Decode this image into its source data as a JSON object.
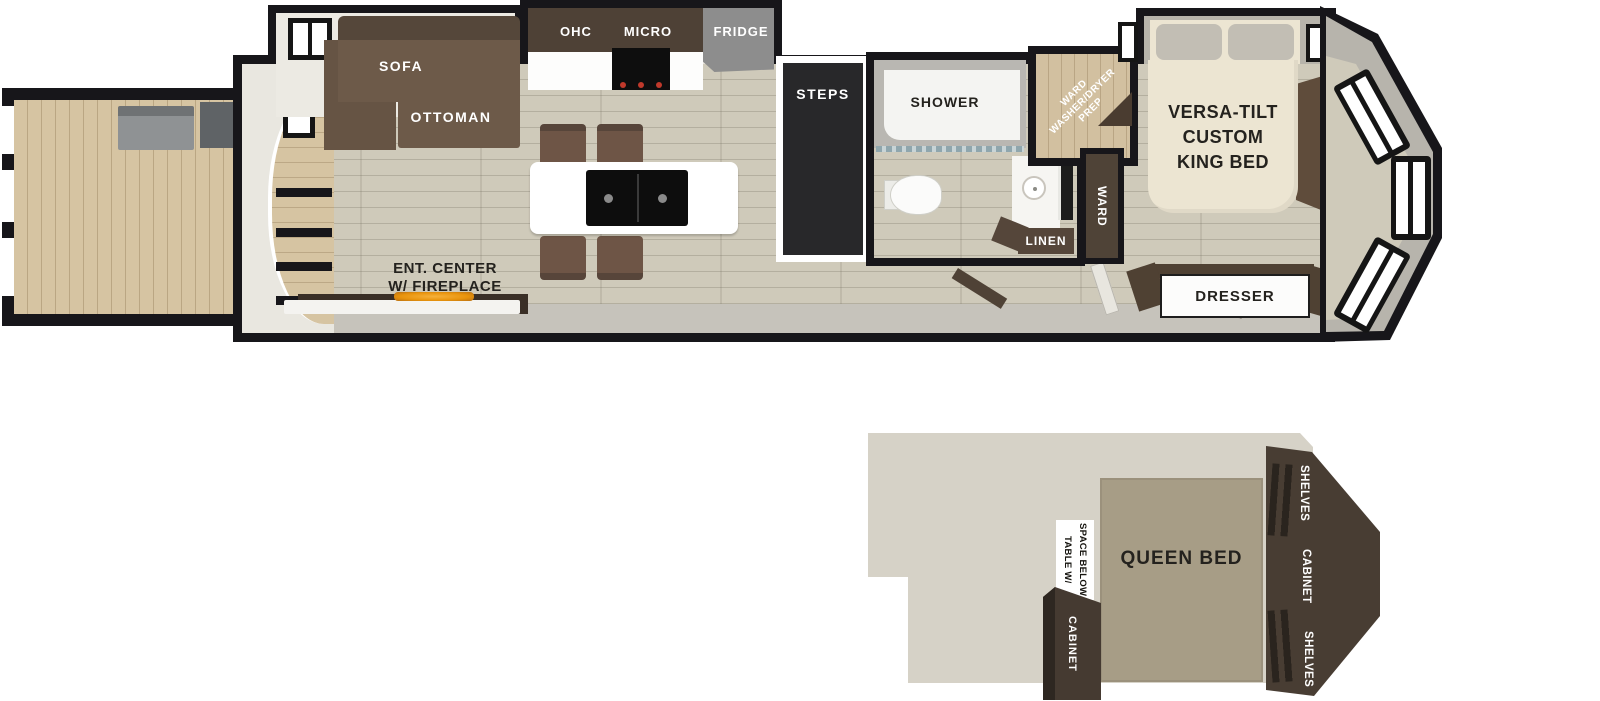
{
  "colors": {
    "wall": "#17161a",
    "floor_main": "#cfcaba",
    "floor_wood": "#d6c4a2",
    "furniture_brown": "#6d5a49",
    "cabinet_dark": "#463a30",
    "counter_white": "#ffffff",
    "fridge_gray": "#8d8d8d",
    "steps_black": "#28282a",
    "bed_cream": "#ece5d2",
    "queen_bed_tan": "#a79d86",
    "loft_floor": "#d6d2c7",
    "fireplace_glow": "#e8930c"
  },
  "main_floor": {
    "living": {
      "sofa": "SOFA",
      "ottoman": "OTTOMAN",
      "ent_center_line1": "ENT. CENTER",
      "ent_center_line2": "W/ FIREPLACE"
    },
    "kitchen": {
      "ohc": "OHC",
      "micro": "MICRO",
      "fridge": "FRIDGE"
    },
    "steps": "STEPS",
    "bath": {
      "shower": "SHOWER",
      "linen": "LINEN"
    },
    "utility": {
      "wd_line1": "WARD",
      "wd_line2": "WASHER/DRYER",
      "wd_line3": "PREP",
      "ward": "WARD"
    },
    "bedroom": {
      "bed_line1": "VERSA-TILT",
      "bed_line2": "CUSTOM",
      "bed_line3": "KING BED",
      "dresser": "DRESSER"
    }
  },
  "loft": {
    "queen_bed": "QUEEN BED",
    "table_line1": "TABLE W/",
    "table_line2": "SPACE BELOW",
    "cabinet": "CABINET",
    "shelves_top": "SHELVES",
    "cabinet_side": "CABINET",
    "shelves_bottom": "SHELVES"
  }
}
